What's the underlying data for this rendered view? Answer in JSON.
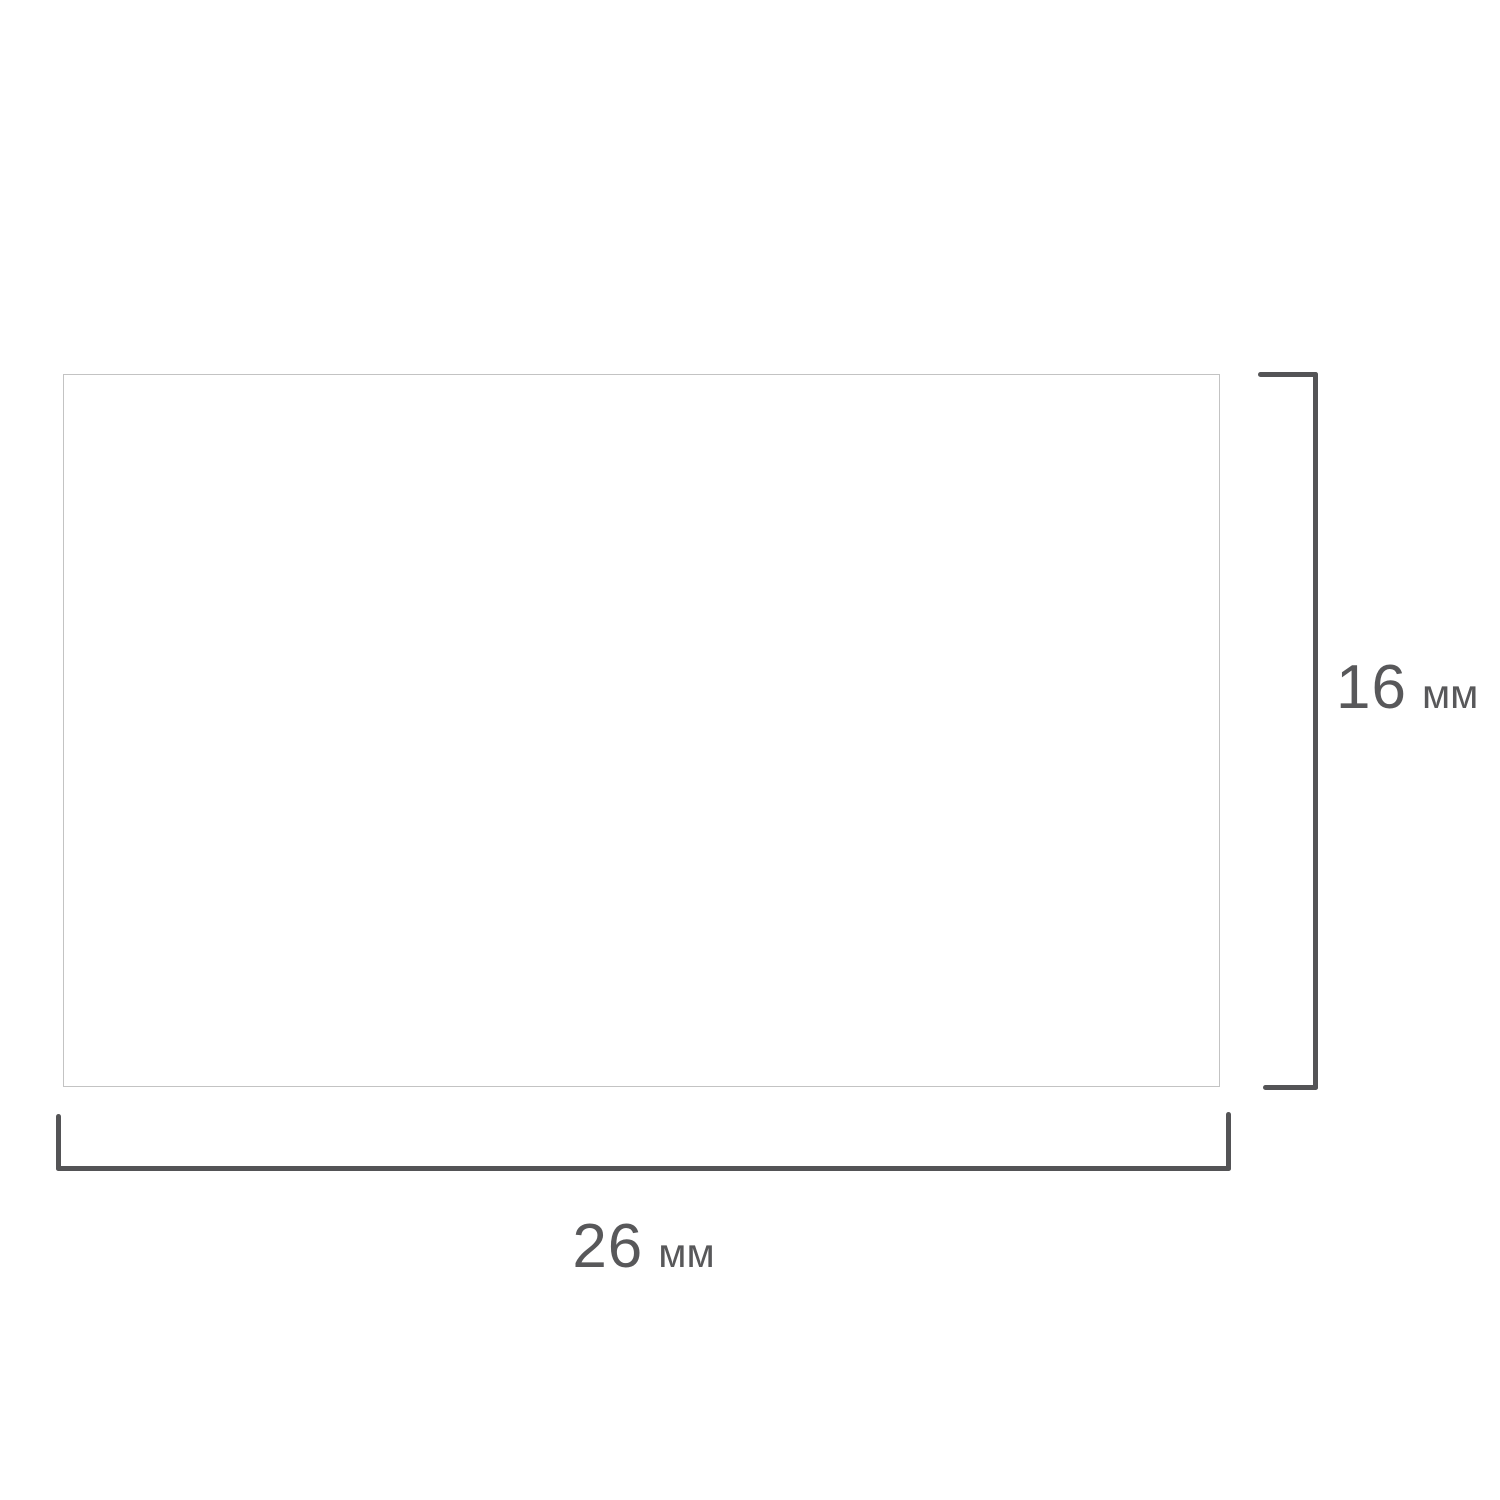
{
  "diagram": {
    "description": "label-size-dimension-drawing",
    "rect": {
      "role": "blank-label"
    },
    "height_dimension": {
      "value": "16",
      "unit": "мм"
    },
    "width_dimension": {
      "value": "26",
      "unit": "мм"
    },
    "colors": {
      "background": "#ffffff",
      "rect-border": "#c3c3c3",
      "dim-line": "#545456",
      "dim-text": "#58585a"
    }
  }
}
